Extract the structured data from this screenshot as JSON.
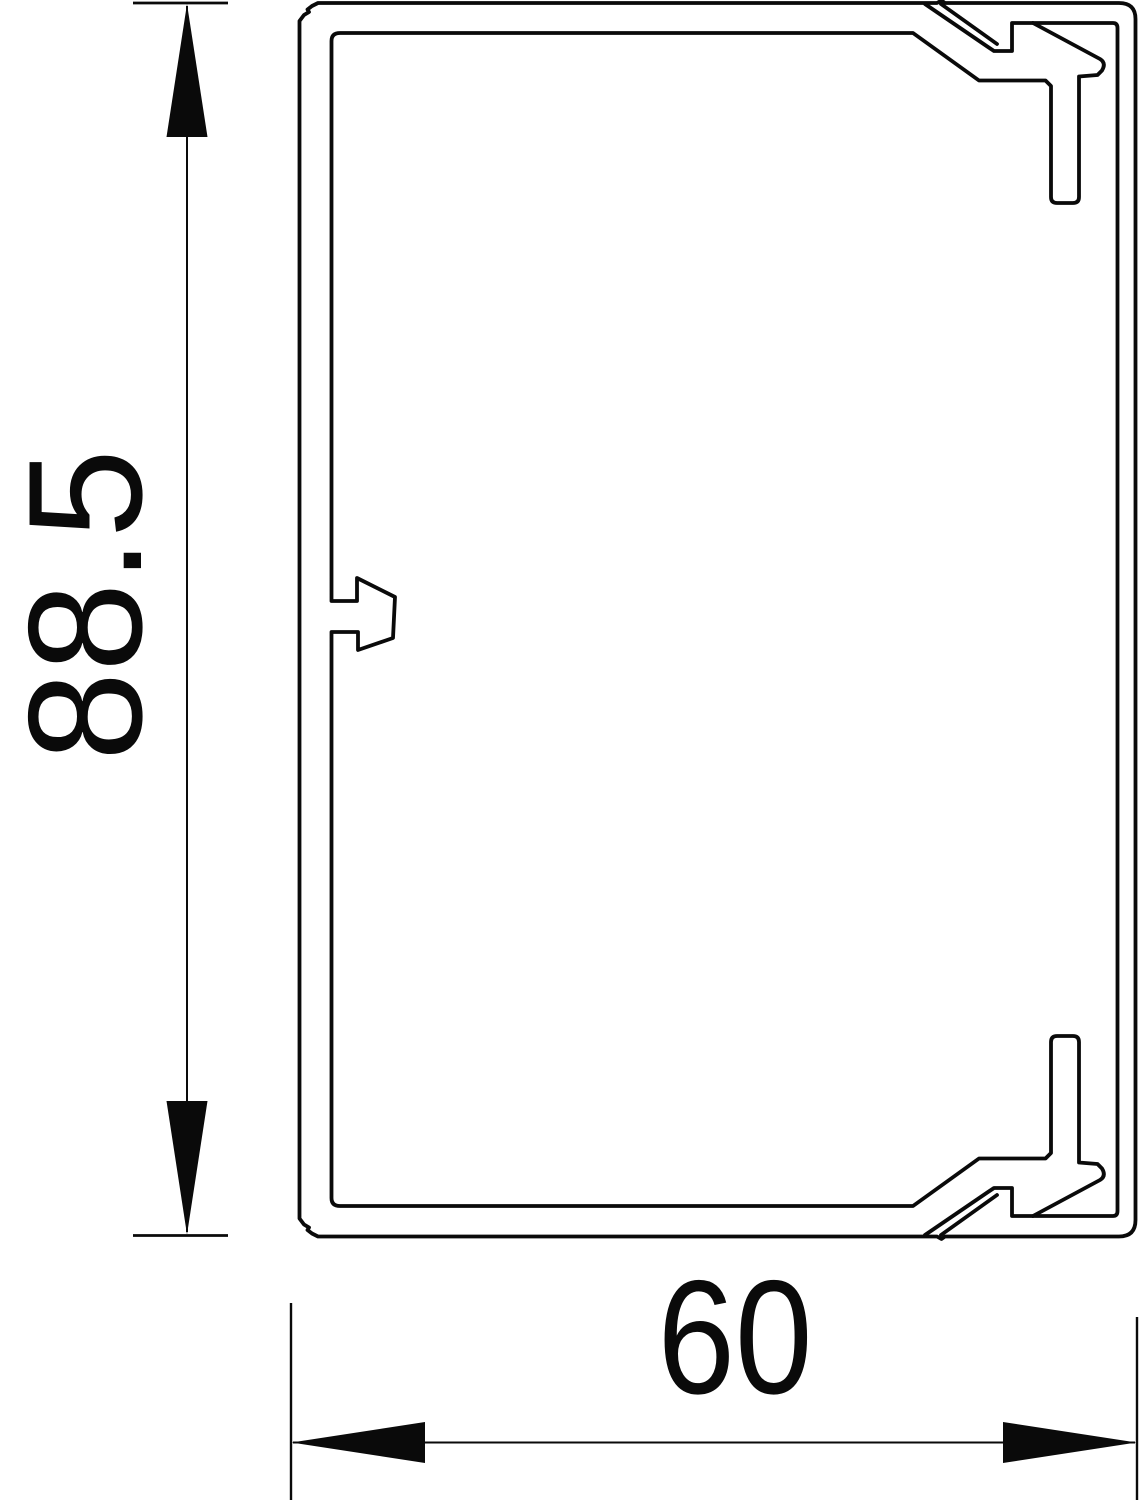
{
  "drawing": {
    "kind": "technical cross-section drawing",
    "background_color": "#ffffff",
    "line_color": "#0a0a0a",
    "dimensions": {
      "height": {
        "label": "88.5"
      },
      "width": {
        "label": "60"
      }
    }
  }
}
